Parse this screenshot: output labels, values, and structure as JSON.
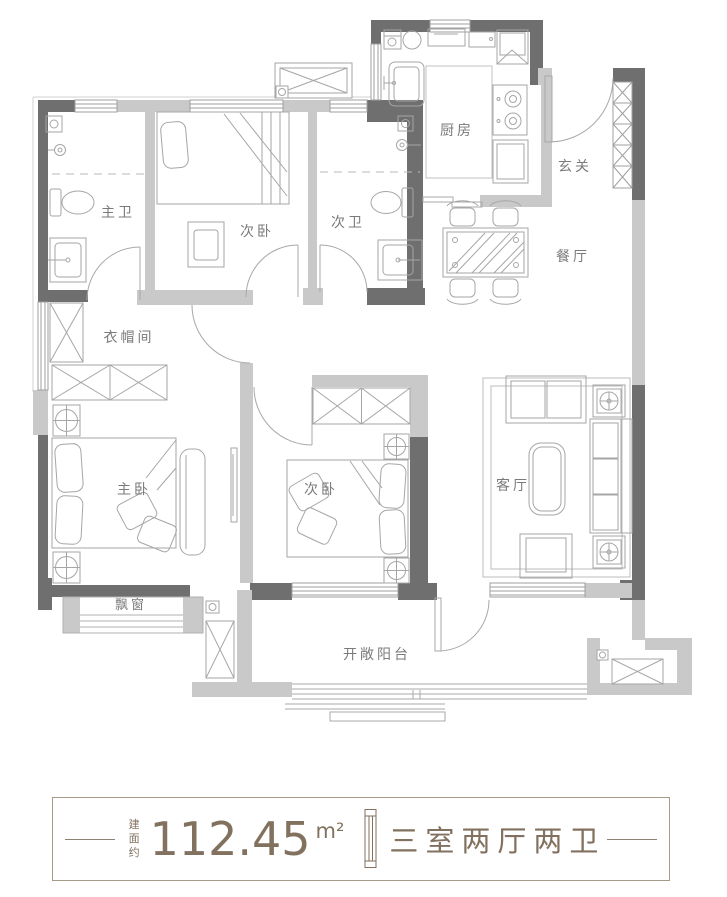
{
  "plan": {
    "rooms": [
      {
        "name": "master-bath",
        "label": "主卫"
      },
      {
        "name": "bedroom-top",
        "label": "次卧"
      },
      {
        "name": "second-bath",
        "label": "次卫"
      },
      {
        "name": "kitchen",
        "label": "厨房"
      },
      {
        "name": "foyer",
        "label": "玄关"
      },
      {
        "name": "dining",
        "label": "餐厅"
      },
      {
        "name": "cloakroom",
        "label": "衣帽间"
      },
      {
        "name": "master-bedroom",
        "label": "主卧"
      },
      {
        "name": "bedroom-bottom",
        "label": "次卧"
      },
      {
        "name": "living",
        "label": "客厅"
      },
      {
        "name": "bay-window",
        "label": "飘窗"
      },
      {
        "name": "balcony",
        "label": "开敞阳台"
      }
    ]
  },
  "footer": {
    "area_prefix": "建面约",
    "area_value": "112.45",
    "area_unit": "m²",
    "layout_text": "三室两厅两卫",
    "divider_icon": "column-ornament"
  },
  "colors": {
    "wall_dark": "#6f6f6f",
    "wall_light": "#c9c9c9",
    "furniture_line": "#a6a6a6",
    "room_label": "#7a7a7a",
    "accent_text": "#82715f",
    "banner_border": "#a89a88"
  }
}
